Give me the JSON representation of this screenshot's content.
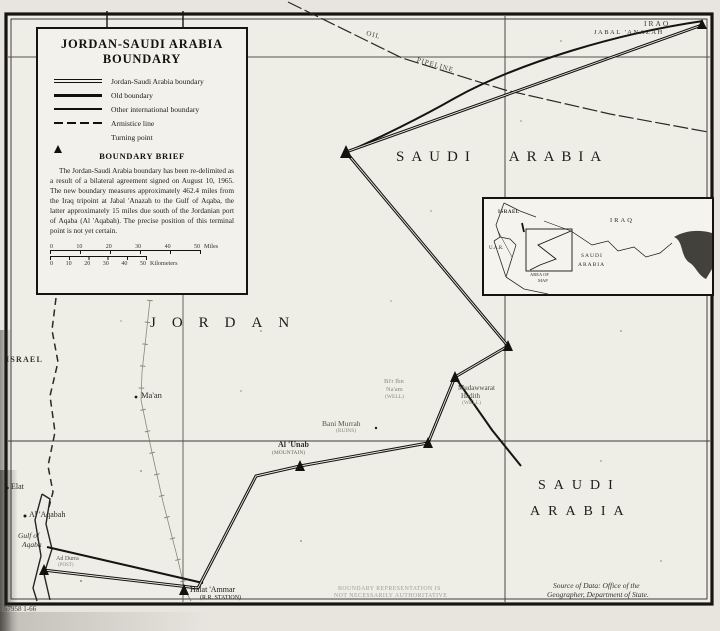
{
  "legend": {
    "title_1": "JORDAN-SAUDI ARABIA",
    "title_2": "BOUNDARY",
    "items": [
      {
        "label": "Jordan-Saudi Arabia boundary",
        "symbol": "double-line"
      },
      {
        "label": "Old boundary",
        "symbol": "thick-line"
      },
      {
        "label": "Other international boundary",
        "symbol": "medium-line"
      },
      {
        "label": "Armistice line",
        "symbol": "dashed-line"
      },
      {
        "label": "Turning point",
        "symbol": "triangle"
      }
    ],
    "brief_heading": "BOUNDARY BRIEF",
    "brief_text": "The Jordan-Saudi Arabia boundary has been re-delimited as a result of a bilateral agreement signed on August 10, 1965.  The new boundary measures approximately 462.4 miles from the Iraq tripoint at Jabal 'Anazah to the Gulf of Aqaba, the latter approximately 15 miles due south of the Jordanian port of Aqaba (Al 'Aqabah).  The precise position of this terminal point is not yet certain.",
    "scale": {
      "miles": [
        "0",
        "10",
        "20",
        "30",
        "40",
        "50"
      ],
      "miles_unit": "Miles",
      "km": [
        "0",
        "10",
        "20",
        "30",
        "40",
        "50"
      ],
      "km_unit": "Kilometers"
    }
  },
  "map": {
    "regions": {
      "jordan": "JORDAN",
      "saudi_north": "SAUDI ARABIA",
      "saudi_south_1": "SAUDI",
      "saudi_south_2": "ARABIA",
      "israel": "ISRAEL",
      "iraq": "IRAQ"
    },
    "features": {
      "jabal_anazah": "JABAL 'ANAZAH",
      "oil": "OIL",
      "pipeline": "PIPELINE"
    },
    "places": {
      "maan": "Ma'an",
      "bir_1": "Bi'r Ibn",
      "bir_2": "Na'am",
      "bir_3": "(WELL)",
      "bani_murrah": "Bani Murrah",
      "bani_murrah_type": "(RUINS)",
      "mudawwarat_1": "Mudawwarat",
      "mudawwarat_2": "Hadith",
      "mudawwarat_3": "(WELL)",
      "al_unab": "Al 'Unab",
      "al_unab_type": "(MOUNTAIN)",
      "halat_ammar": "Halat 'Ammar",
      "halat_ammar_type": "(R.R. STATION)",
      "elat": "Elat",
      "al_aqabah": "Al 'Aqabah",
      "gulf_1": "Gulf of",
      "gulf_2": "Aqaba",
      "ad_durra": "Ad Durra",
      "ad_durra_type": "(POST)"
    },
    "inset": {
      "israel": "ISRAEL",
      "uar": "U.A.R.",
      "iraq": "IRAQ",
      "saudi_1": "SAUDI",
      "saudi_2": "ARABIA",
      "area_1": "AREA OF",
      "area_2": "MAP"
    },
    "notes": {
      "disclaimer_1": "BOUNDARY REPRESENTATION IS",
      "disclaimer_2": "NOT NECESSARILY AUTHORITATIVE",
      "source_1": "Source of Data:  Office of the",
      "source_2": "Geographer, Department of State.",
      "map_number": "57958 1-66"
    }
  },
  "colors": {
    "ink": "#16140f",
    "paper": "#e7e5de",
    "gray_label": "#8d897f"
  }
}
